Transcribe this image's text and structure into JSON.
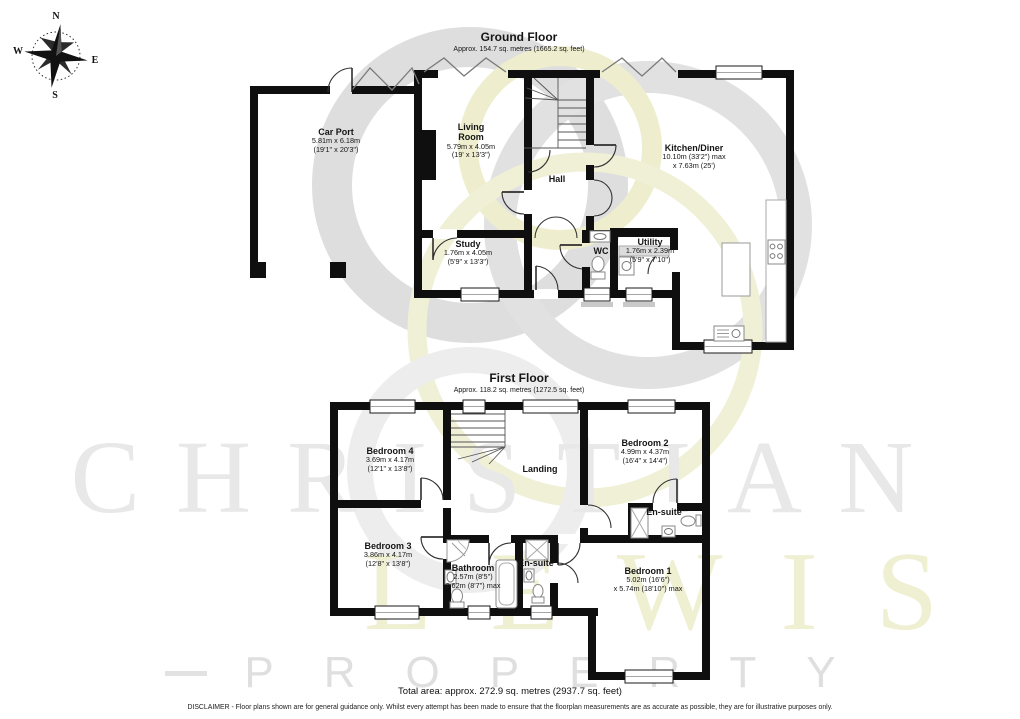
{
  "compass": {
    "n": "N",
    "e": "E",
    "s": "S",
    "w": "W"
  },
  "watermark": {
    "line1": "CHRISTIAN",
    "line2": "LEWIS",
    "line3": "PROPERTY"
  },
  "colors": {
    "wall": "#0f0f0f",
    "watermark_gray": "#dcdcdc",
    "watermark_yellow": "#eeeecf",
    "sill_gray": "#c9c9c9"
  },
  "ground_floor": {
    "title": "Ground Floor",
    "subtitle": "Approx. 154.7 sq. metres (1665.2 sq. feet)",
    "rooms": {
      "car_port": {
        "name": "Car Port",
        "metric": "5.81m x 6.18m",
        "imperial": "(19'1\" x 20'3\")"
      },
      "living_room": {
        "name": "Living Room",
        "metric": "5.79m x 4.05m",
        "imperial": "(19' x 13'3\")"
      },
      "hall": {
        "name": "Hall"
      },
      "kitchen_diner": {
        "name": "Kitchen/Diner",
        "metric": "10.10m (33'2\") max",
        "imperial": "x 7.63m (25')"
      },
      "study": {
        "name": "Study",
        "metric": "1.76m x 4.05m",
        "imperial": "(5'9\" x 13'3\")"
      },
      "wc": {
        "name": "WC"
      },
      "utility": {
        "name": "Utility",
        "metric": "1.76m x 2.39m",
        "imperial": "(5'9\" x 7'10\")"
      }
    }
  },
  "first_floor": {
    "title": "First Floor",
    "subtitle": "Approx. 118.2 sq. metres (1272.5 sq. feet)",
    "rooms": {
      "bedroom4": {
        "name": "Bedroom 4",
        "metric": "3.69m x 4.17m",
        "imperial": "(12'1\" x 13'8\")"
      },
      "bedroom2": {
        "name": "Bedroom 2",
        "metric": "4.99m x 4.37m",
        "imperial": "(16'4\" x 14'4\")"
      },
      "landing": {
        "name": "Landing"
      },
      "bedroom3": {
        "name": "Bedroom 3",
        "metric": "3.86m x 4.17m",
        "imperial": "(12'8\" x 13'8\")"
      },
      "bathroom": {
        "name": "Bathroom",
        "metric": "2.57m (8'5\")",
        "imperial": "2.62m (8'7\") max"
      },
      "ensuite_center": {
        "name": "En-suite"
      },
      "ensuite_right": {
        "name": "En-suite"
      },
      "bedroom1": {
        "name": "Bedroom 1",
        "metric": "5.02m (16'6\")",
        "imperial": "x 5.74m (18'10\") max"
      }
    }
  },
  "footer": {
    "total_area": "Total area: approx. 272.9 sq. metres (2937.7 sq. feet)",
    "disclaimer": "DISCLAIMER -  Floor plans shown are for general guidance only.  Whilst every attempt has been made to ensure that the floorplan measurements are as accurate as possible, they are for illustrative purposes only."
  }
}
